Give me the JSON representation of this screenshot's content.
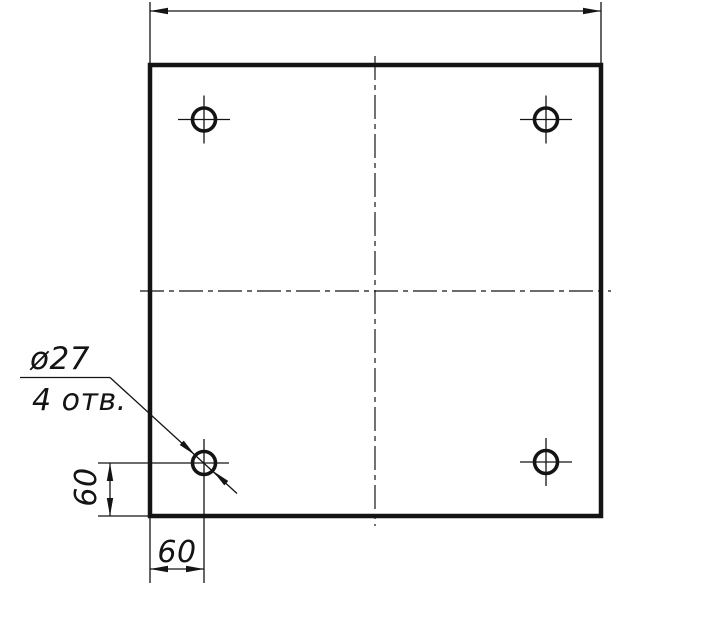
{
  "drawing": {
    "kind": "engineering-drawing",
    "ink_color": "#141414",
    "background_color": "#ffffff",
    "callout": {
      "diameter_label": "ø27",
      "count_label": "4 отв."
    },
    "dimensions": {
      "vertical_offset_label": "60",
      "horizontal_offset_label": "60"
    }
  }
}
